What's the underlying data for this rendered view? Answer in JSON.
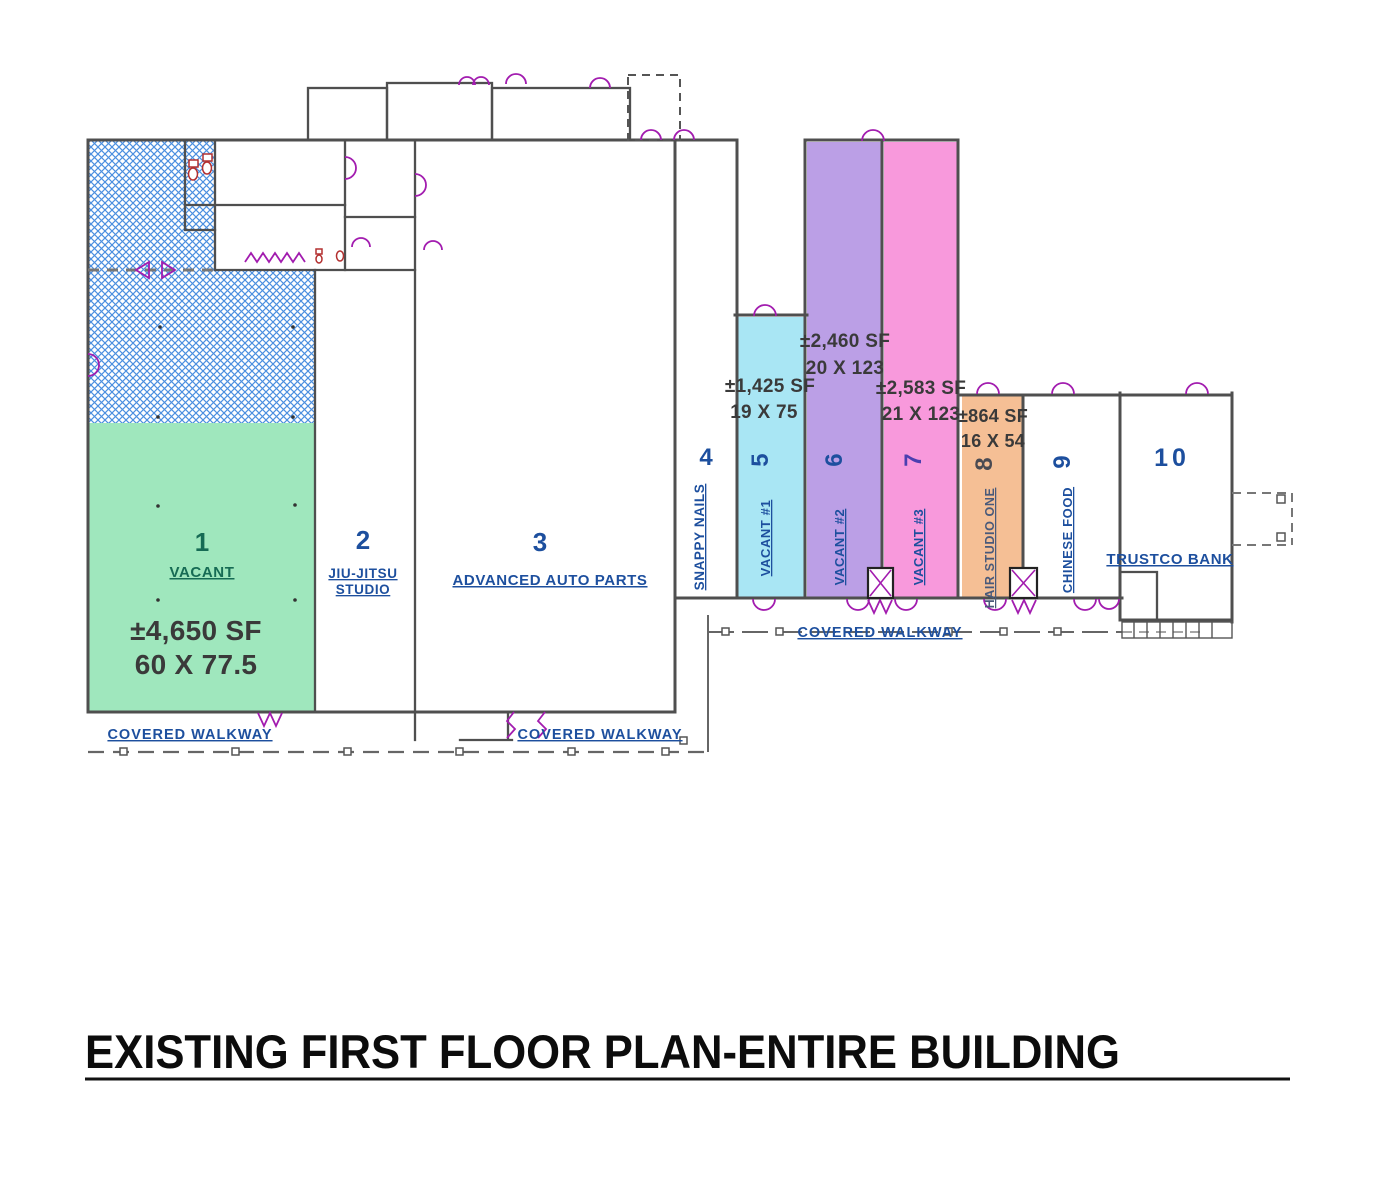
{
  "title": "EXISTING FIRST FLOOR PLAN-ENTIRE BUILDING",
  "colors": {
    "unit1_fill": "#9fe7bd",
    "unit5_fill": "#a9e6f4",
    "unit6_fill": "#bb9fe6",
    "unit7_fill": "#f899dc",
    "unit8_fill": "#f5bf95",
    "hatch_blue": "#4b8fe0",
    "label_blue": "#1d4f9e",
    "unit1_text": "#166b54",
    "area_text": "#3a3a3a",
    "door_magenta": "#a21caf",
    "wall_gray": "#4f4f4f"
  },
  "units": [
    {
      "number": "1",
      "name": "VACANT",
      "area": "±4,650 SF",
      "dims": "60 X 77.5"
    },
    {
      "number": "2",
      "name_lines": [
        "JIU-JITSU",
        "STUDIO"
      ]
    },
    {
      "number": "3",
      "name": "ADVANCED AUTO PARTS"
    },
    {
      "number": "4",
      "name": "SNAPPY NAILS"
    },
    {
      "number": "5",
      "name": "VACANT #1",
      "area": "±1,425 SF",
      "dims": "19 X 75"
    },
    {
      "number": "6",
      "name": "VACANT #2",
      "area": "±2,460 SF",
      "dims": "20 X 123"
    },
    {
      "number": "7",
      "name": "VACANT #3",
      "area": "±2,583 SF",
      "dims": "21 X 123"
    },
    {
      "number": "8",
      "name": "HAIR STUDIO ONE",
      "area": "±864 SF",
      "dims": "16 X 54"
    },
    {
      "number": "9",
      "name": "CHINESE FOOD"
    },
    {
      "number": "10",
      "name": "TRUSTCO BANK"
    }
  ],
  "walkways": {
    "bottom_left": "COVERED WALKWAY",
    "bottom_right": "COVERED WALKWAY",
    "middle": "COVERED WALKWAY"
  }
}
